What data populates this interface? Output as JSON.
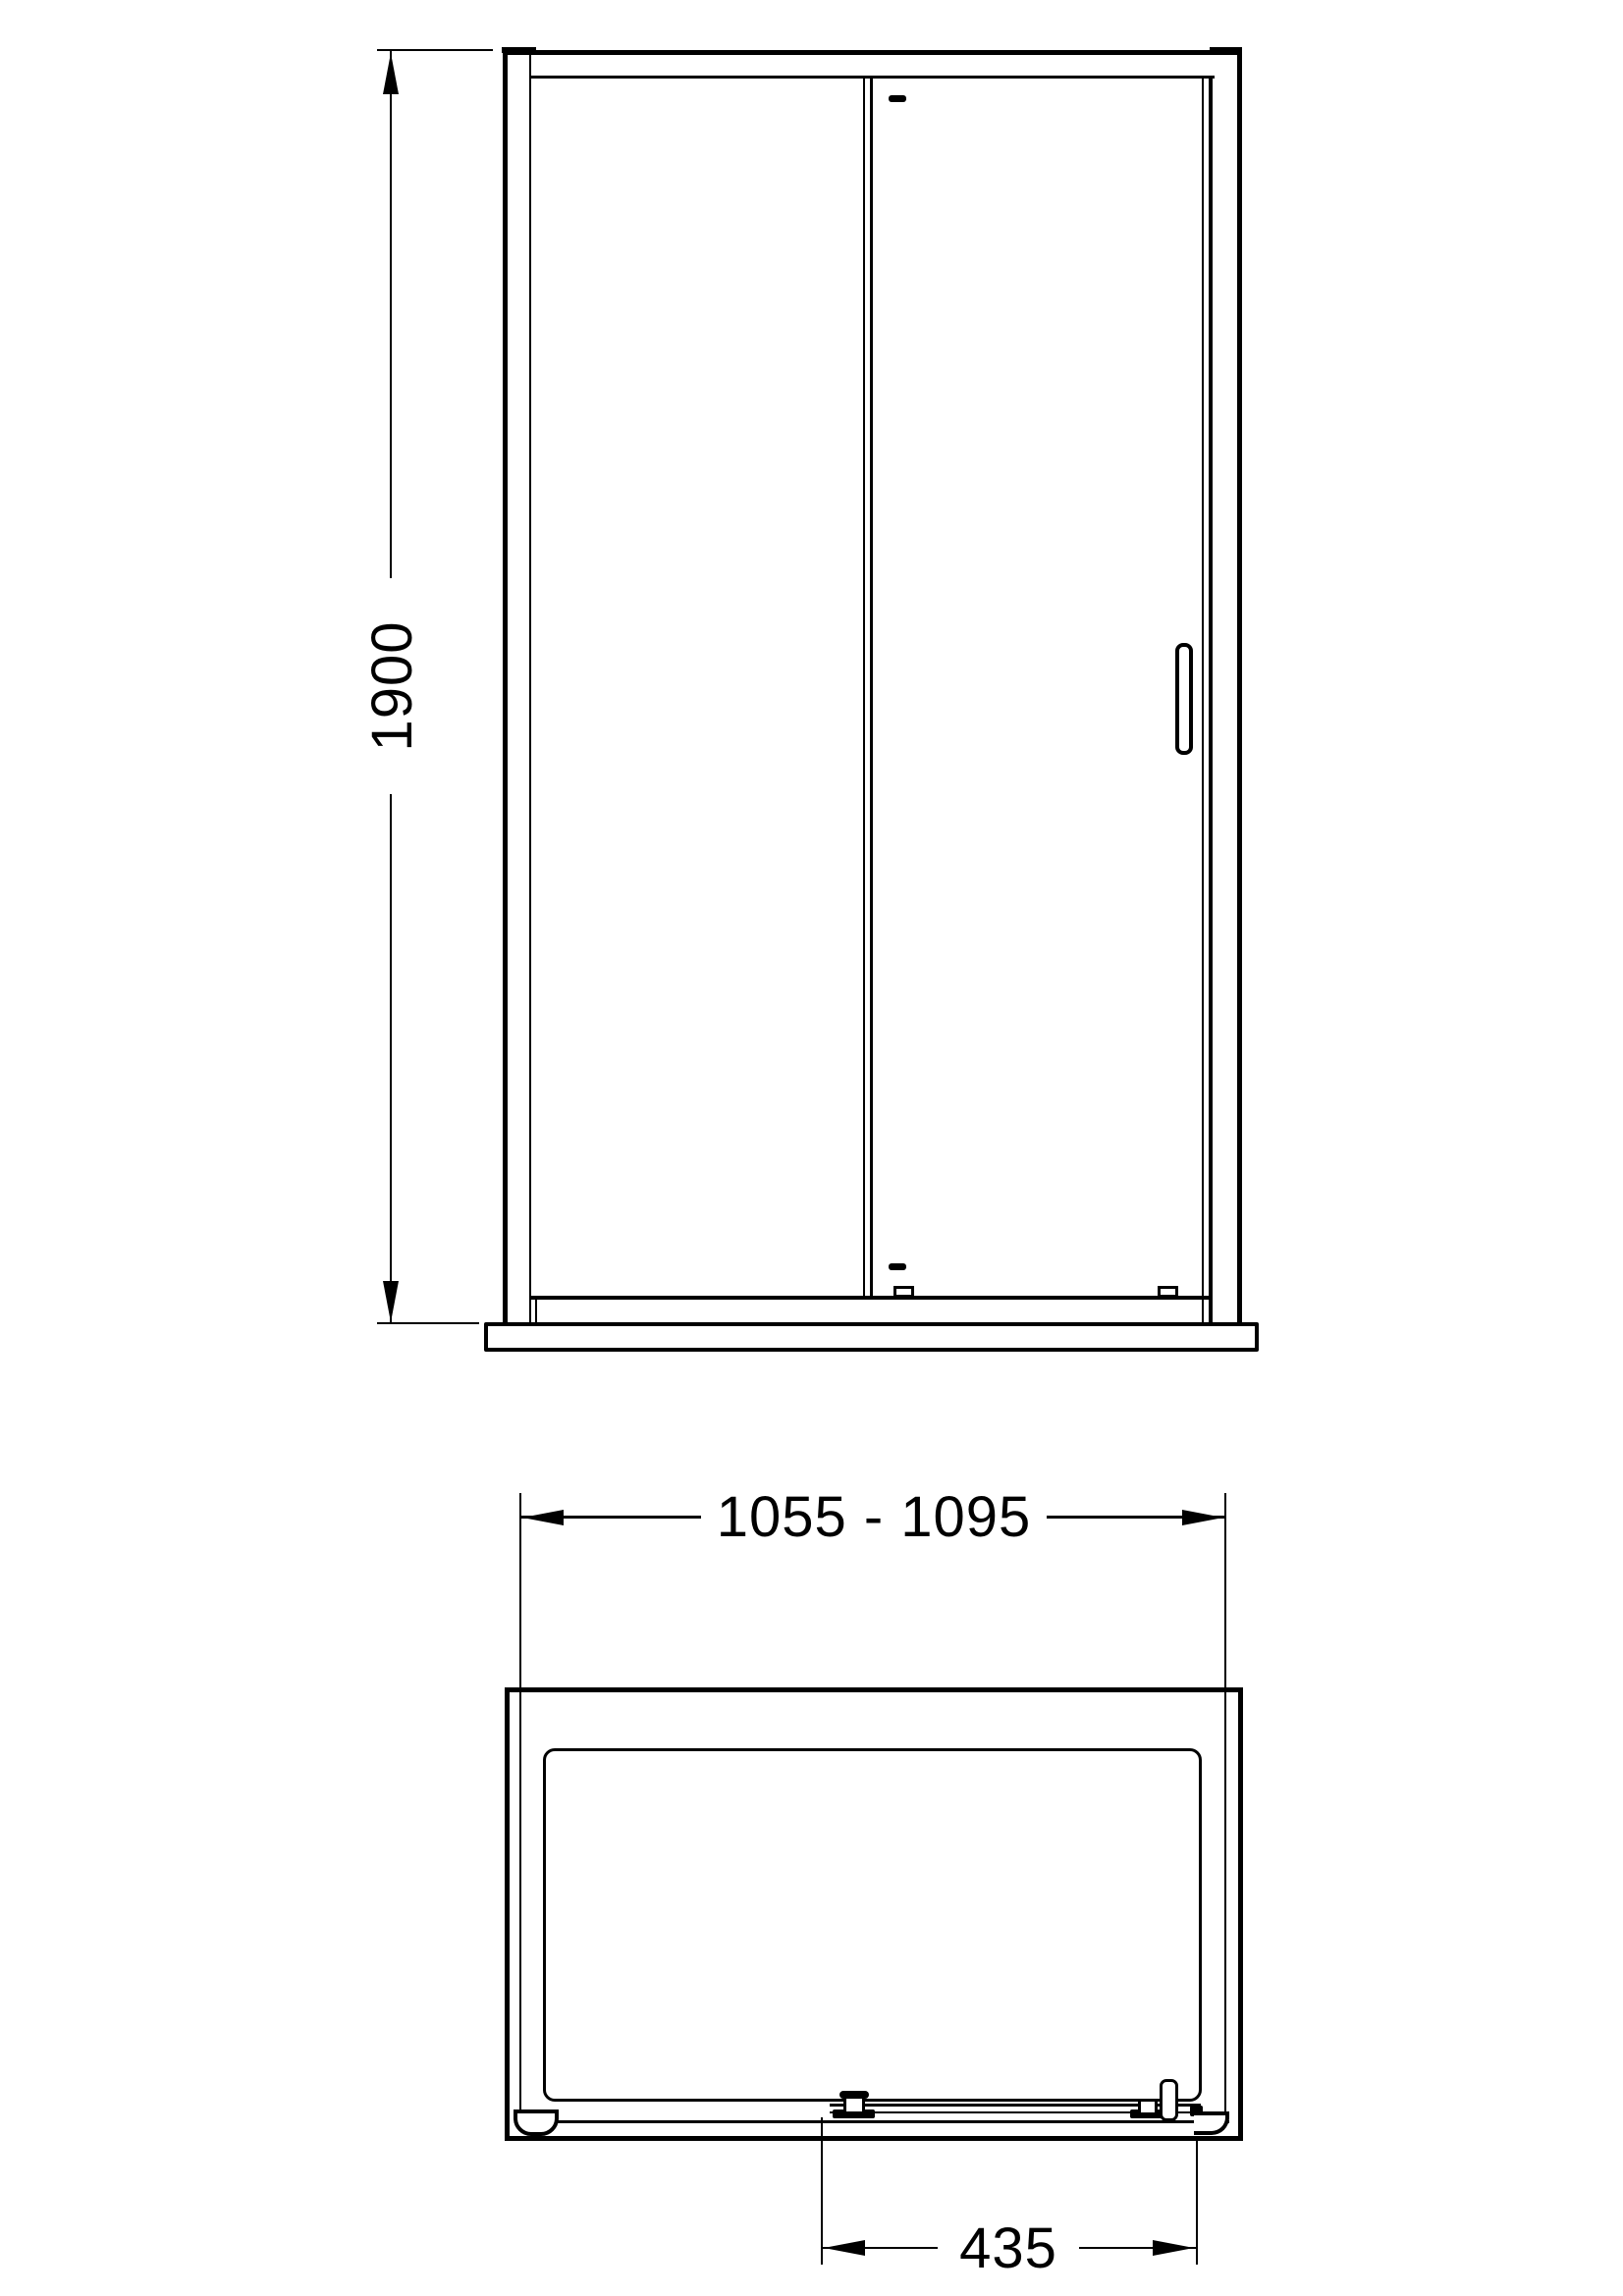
{
  "colors": {
    "line": "#000000",
    "background": "#ffffff"
  },
  "dimensions": {
    "height_mm": "1900",
    "width_range_mm": "1055 - 1095",
    "handle_offset_mm": "435"
  }
}
